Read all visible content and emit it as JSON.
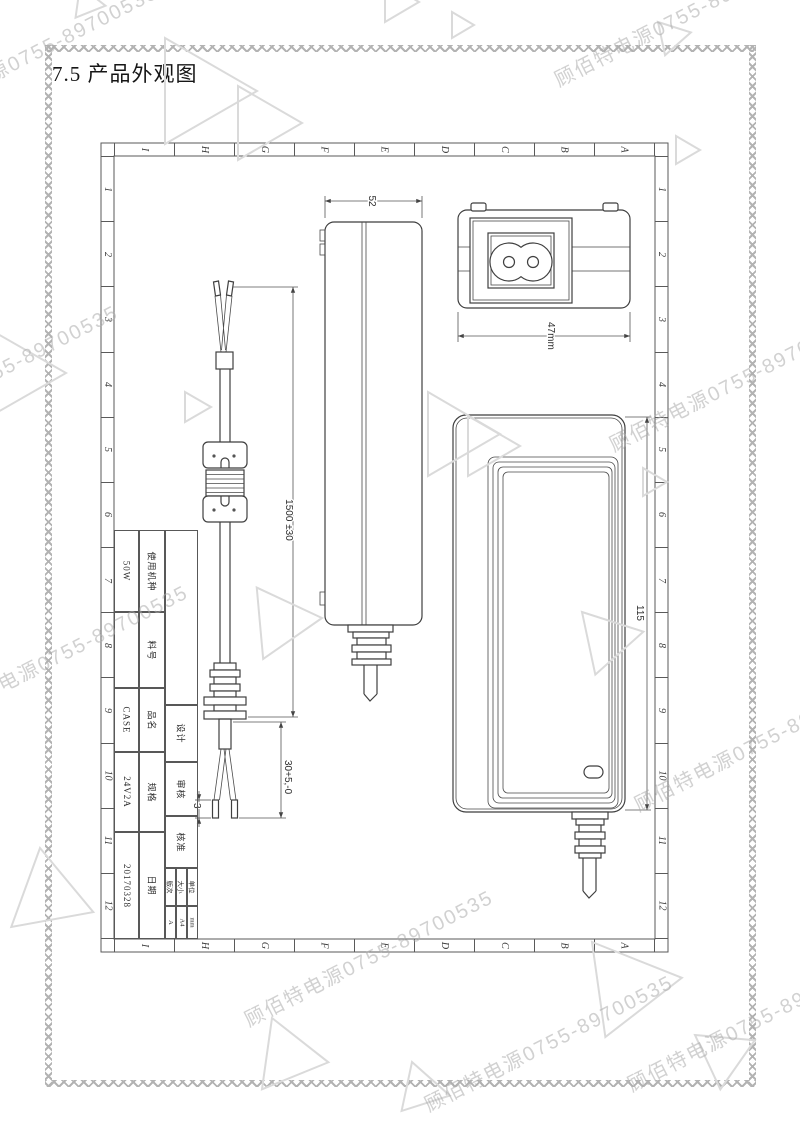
{
  "page": {
    "title": "7.5 产品外观图"
  },
  "watermark": {
    "text": "顾佰特电源0755-89700535"
  },
  "frame": {
    "columns": [
      "I",
      "H",
      "G",
      "F",
      "E",
      "D",
      "C",
      "B",
      "A"
    ],
    "rows": [
      "1",
      "2",
      "3",
      "4",
      "5",
      "6",
      "7",
      "8",
      "9",
      "10",
      "11",
      "12"
    ]
  },
  "title_block": {
    "rows": [
      {
        "label": "使用机种",
        "value": "50W"
      },
      {
        "label": "料号",
        "value": ""
      },
      {
        "label": "品名",
        "value": "CASE"
      },
      {
        "label": "规格",
        "value": "24V2A"
      },
      {
        "label": "日期",
        "value": "20170328"
      }
    ],
    "sign_cells": [
      "设计",
      "审核",
      "核准"
    ],
    "meta_cells": [
      {
        "label": "版次",
        "value": "A"
      },
      {
        "label": "大小",
        "value": "A4"
      },
      {
        "label": "单位",
        "value": "mm"
      }
    ]
  },
  "dimensions": {
    "adapter_thickness": "52",
    "adapter_width": "47mm",
    "adapter_length": "115",
    "cable_length": "1500 ±30",
    "wire_split_length": "30+5,-0",
    "strip_tin_length": "3"
  },
  "colors": {
    "line": "#3f3f3f",
    "watermark": "#acacac"
  }
}
